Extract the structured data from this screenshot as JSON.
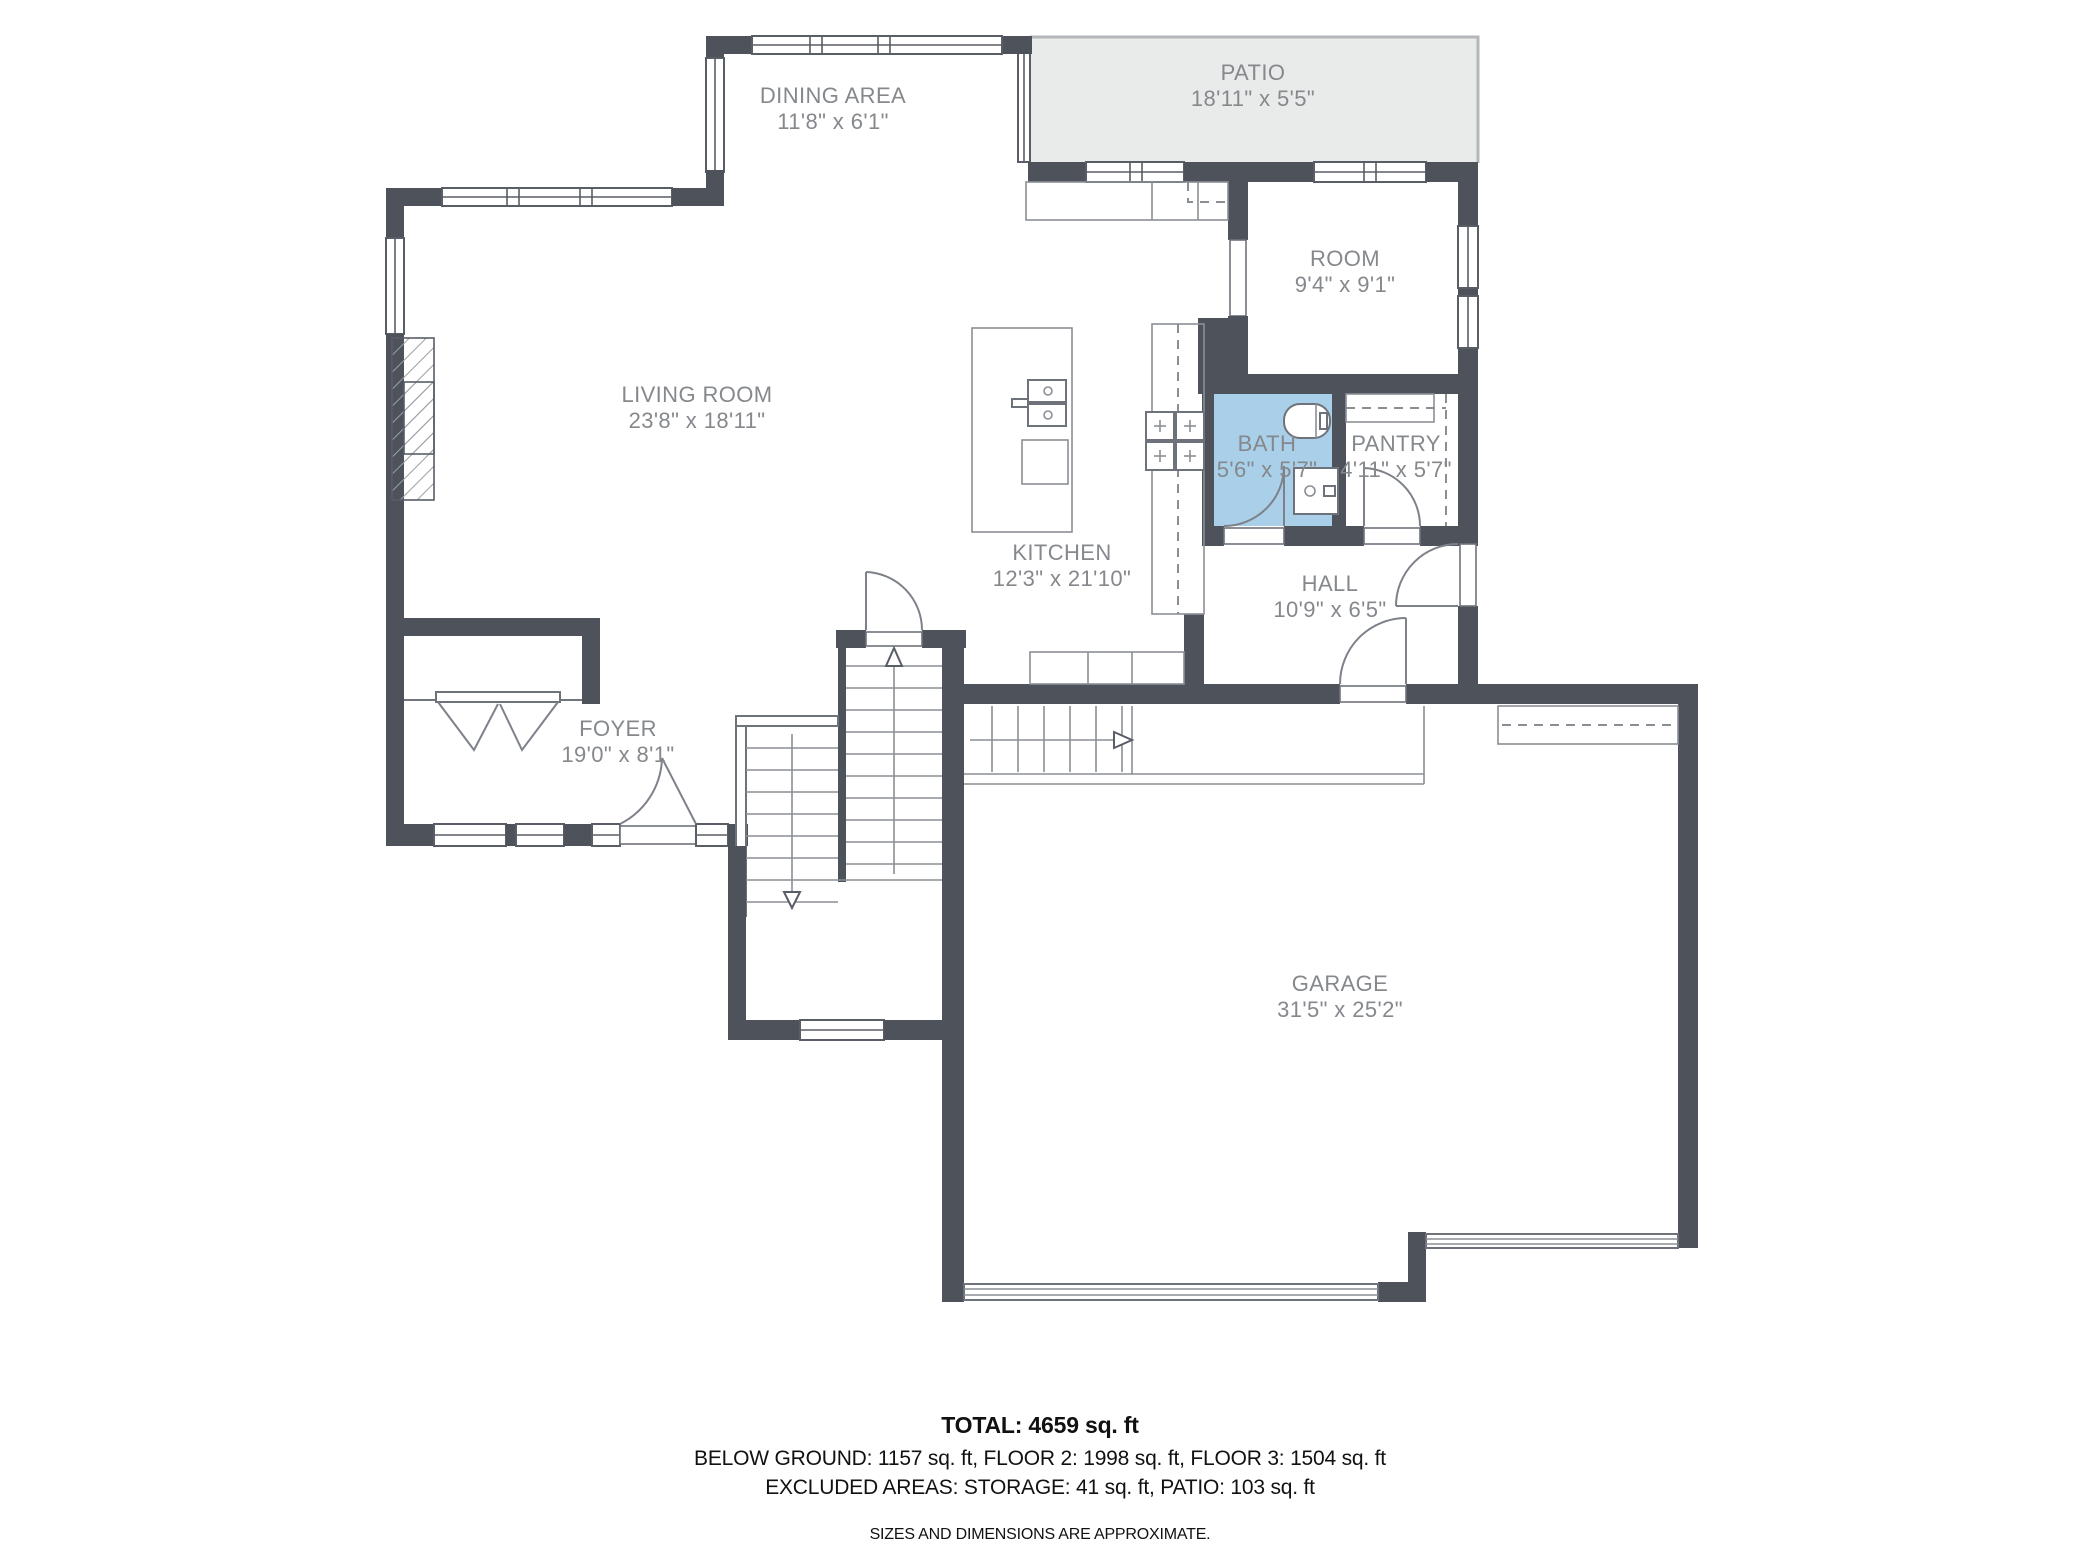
{
  "floor_plan": {
    "rooms": [
      {
        "id": "dining",
        "name": "DINING AREA",
        "dims": "11'8\" x 6'1\""
      },
      {
        "id": "patio",
        "name": "PATIO",
        "dims": "18'11\" x 5'5\""
      },
      {
        "id": "room",
        "name": "ROOM",
        "dims": "9'4\" x 9'1\""
      },
      {
        "id": "living",
        "name": "LIVING ROOM",
        "dims": "23'8\" x 18'11\""
      },
      {
        "id": "kitchen",
        "name": "KITCHEN",
        "dims": "12'3\" x 21'10\""
      },
      {
        "id": "bath",
        "name": "BATH",
        "dims": "5'6\" x 5'7\""
      },
      {
        "id": "pantry",
        "name": "PANTRY",
        "dims": "4'11\" x 5'7\""
      },
      {
        "id": "hall",
        "name": "HALL",
        "dims": "10'9\" x 6'5\""
      },
      {
        "id": "foyer",
        "name": "FOYER",
        "dims": "19'0\" x 8'1\""
      },
      {
        "id": "garage",
        "name": "GARAGE",
        "dims": "31'5\" x 25'2\""
      }
    ],
    "summary": {
      "total": "TOTAL: 4659 sq. ft",
      "floors": "BELOW GROUND: 1157 sq. ft, FLOOR 2: 1998 sq. ft, FLOOR 3: 1504 sq. ft",
      "excluded": "EXCLUDED AREAS: STORAGE: 41 sq. ft, PATIO: 103 sq. ft",
      "disclaimer": "SIZES AND DIMENSIONS ARE APPROXIMATE."
    },
    "colors": {
      "wall": "#4d525b",
      "bath_highlight": "#a9cfe9",
      "patio_fill": "#e9eaea",
      "label": "#85888c"
    }
  }
}
